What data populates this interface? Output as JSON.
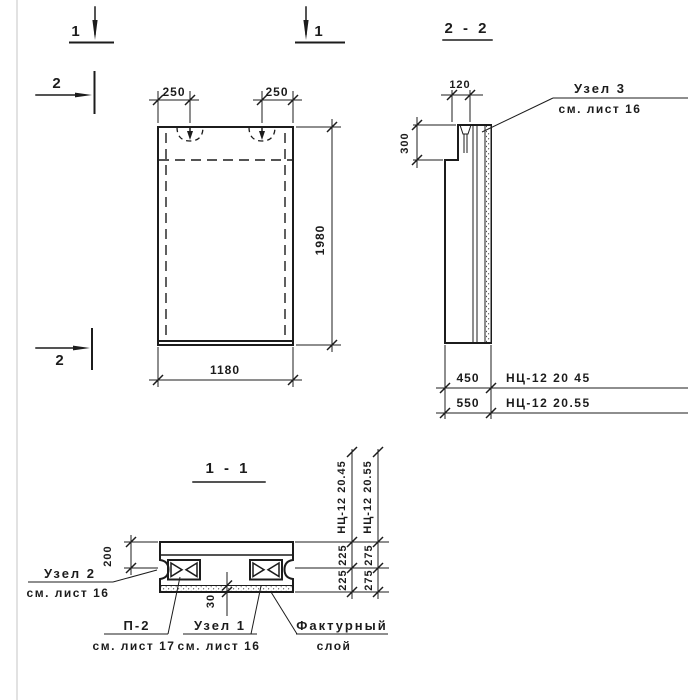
{
  "markers": {
    "cut1": "1",
    "cut2": "2"
  },
  "front_view": {
    "dim_loop_left": "250",
    "dim_loop_right": "250",
    "dim_height": "1980",
    "dim_width": "1180"
  },
  "section22": {
    "title": "2 - 2",
    "dim_top": "120",
    "dim_step": "300",
    "callout_node3_line1": "Узел 3",
    "callout_node3_line2": "см. лист 16",
    "row1_dim": "450",
    "row1_mark": "НЦ-12 20 45",
    "row2_dim": "550",
    "row2_mark": "НЦ-12 20.55"
  },
  "section11": {
    "title": "1 - 1",
    "dim_top": "200",
    "dim_layer": "30",
    "node2_line1": "Узел 2",
    "node2_line2": "см. лист 16",
    "p2_line1": "П-2",
    "p2_line2": "см. лист 17",
    "node1_line1": "Узел 1",
    "node1_line2": "см. лист 16",
    "facing_line1": "Фактурный",
    "facing_line2": "слой",
    "col1_mark": "НЦ-12 20.45",
    "col1_dim_top": "225",
    "col1_dim_bottom": "225",
    "col2_mark": "НЦ-12 20.55",
    "col2_dim_top": "275",
    "col2_dim_bottom": "275"
  }
}
